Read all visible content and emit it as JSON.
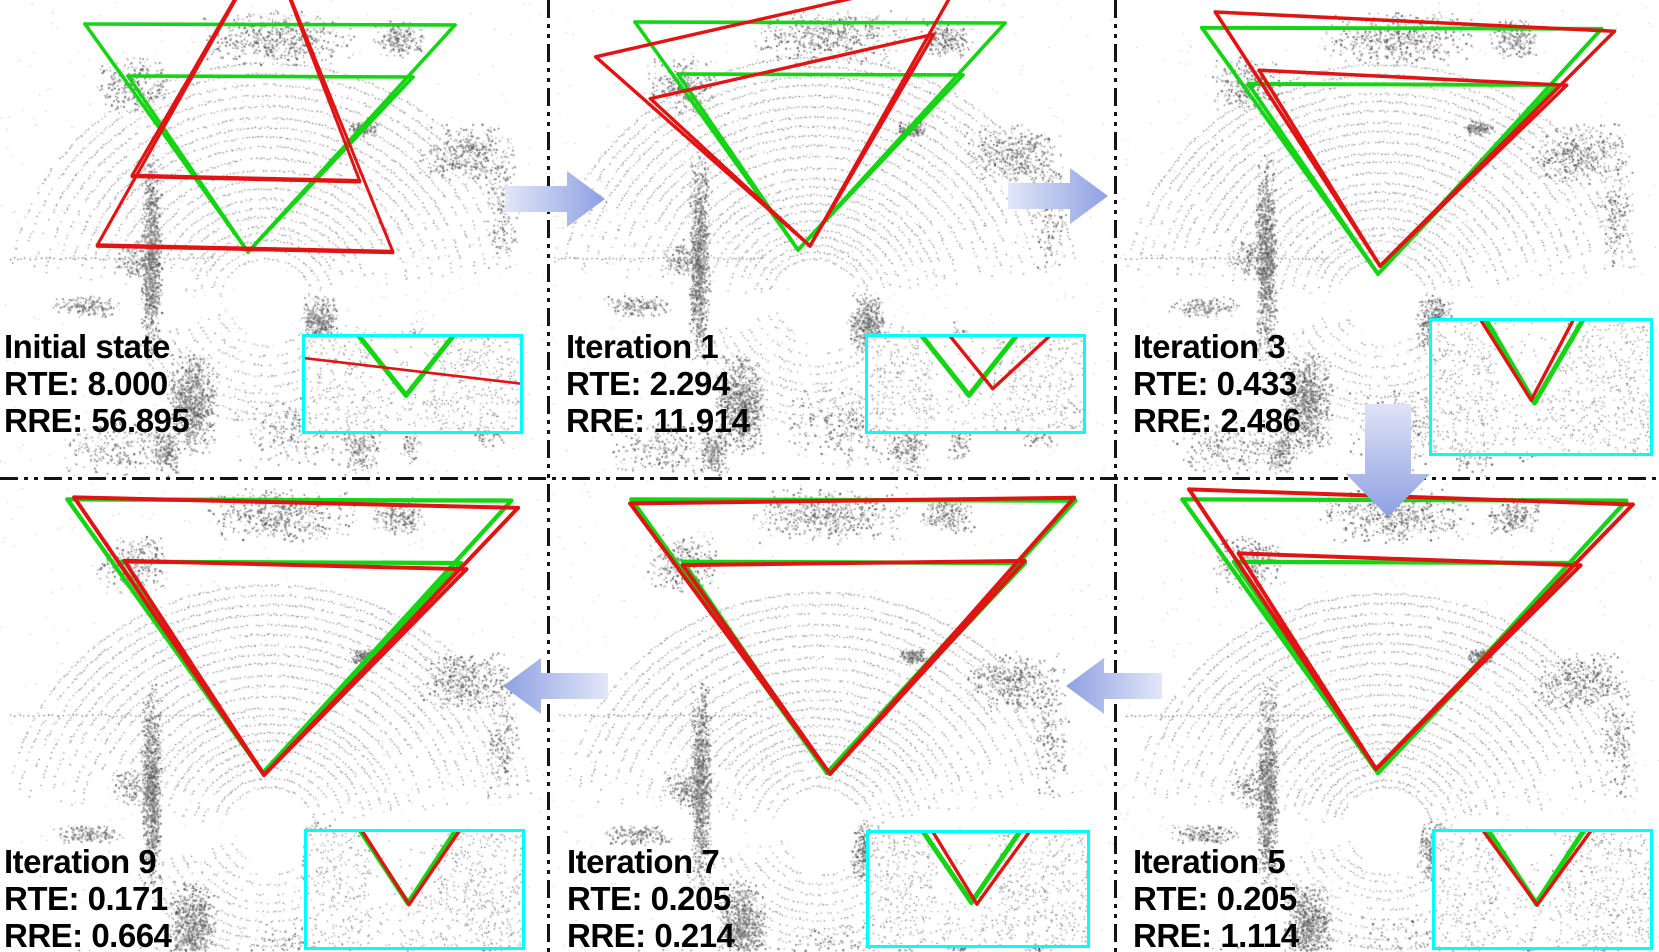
{
  "figure": {
    "panels": [
      {
        "id": "initial",
        "label": "Initial state",
        "rte_text": "RTE: 8.000",
        "rre_text": "RRE: 56.895"
      },
      {
        "id": "iter1",
        "label": "Iteration 1",
        "rte_text": "RTE: 2.294",
        "rre_text": "RRE: 11.914"
      },
      {
        "id": "iter3",
        "label": "Iteration 3",
        "rte_text": "RTE: 0.433",
        "rre_text": "RRE: 2.486"
      },
      {
        "id": "iter9",
        "label": "Iteration 9",
        "rte_text": "RTE: 0.171",
        "rre_text": "RRE: 0.664"
      },
      {
        "id": "iter7",
        "label": "Iteration 7",
        "rte_text": "RTE: 0.205",
        "rre_text": "RRE: 0.214"
      },
      {
        "id": "iter5",
        "label": "Iteration 5",
        "rte_text": "RTE: 0.205",
        "rre_text": "RRE: 1.114"
      }
    ],
    "arrows": [
      {
        "icon": "arrow-right-icon"
      },
      {
        "icon": "arrow-right-icon"
      },
      {
        "icon": "arrow-down-icon"
      },
      {
        "icon": "arrow-left-icon"
      },
      {
        "icon": "arrow-left-icon"
      }
    ],
    "colors": {
      "estimated_pose": "#e01414",
      "ground_truth_pose": "#14d414",
      "inset_border": "#00ffff",
      "divider": "#141414",
      "arrow_light": "#dfe4f7",
      "arrow_dark": "#8da0e2",
      "text": "#000000",
      "background": "#ffffff"
    }
  }
}
